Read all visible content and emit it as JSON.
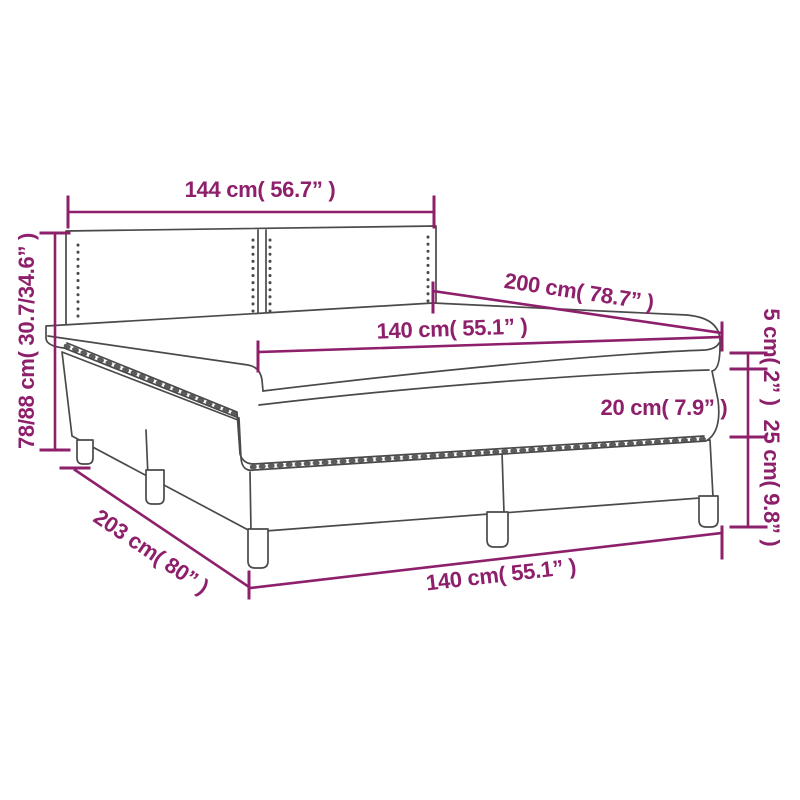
{
  "diagram": {
    "type": "product-dimension-diagram",
    "subject": "box spring bed with headboard, mattress and topper",
    "colors": {
      "accent_magenta": "#8E1F6B",
      "line_art_gray": "#4A4A4A",
      "background": "#FFFFFF"
    },
    "dimensions": {
      "headboard_width": {
        "cm": "144",
        "in": "56.7",
        "text": "144 cm( 56.7” )"
      },
      "bed_height": {
        "cm": "78/88",
        "in": "30.7/34.6",
        "text": "78/88 cm( 30.7/34.6” )"
      },
      "bed_length": {
        "cm": "200",
        "in": "78.7",
        "text": "200 cm( 78.7” )"
      },
      "mattress_width": {
        "cm": "140",
        "in": "55.1",
        "text": "140 cm( 55.1” )"
      },
      "topper_height": {
        "cm": "5",
        "in": "2",
        "text": "5 cm( 2” )"
      },
      "mattress_height": {
        "cm": "20",
        "in": "7.9",
        "text": "20 cm( 7.9” )"
      },
      "base_height": {
        "cm": "25",
        "in": "9.8",
        "text": "25 cm( 9.8” )"
      },
      "base_length": {
        "cm": "203",
        "in": "80",
        "text": "203 cm( 80” )"
      },
      "base_width": {
        "cm": "140",
        "in": "55.1",
        "text": "140 cm( 55.1” )"
      }
    }
  }
}
